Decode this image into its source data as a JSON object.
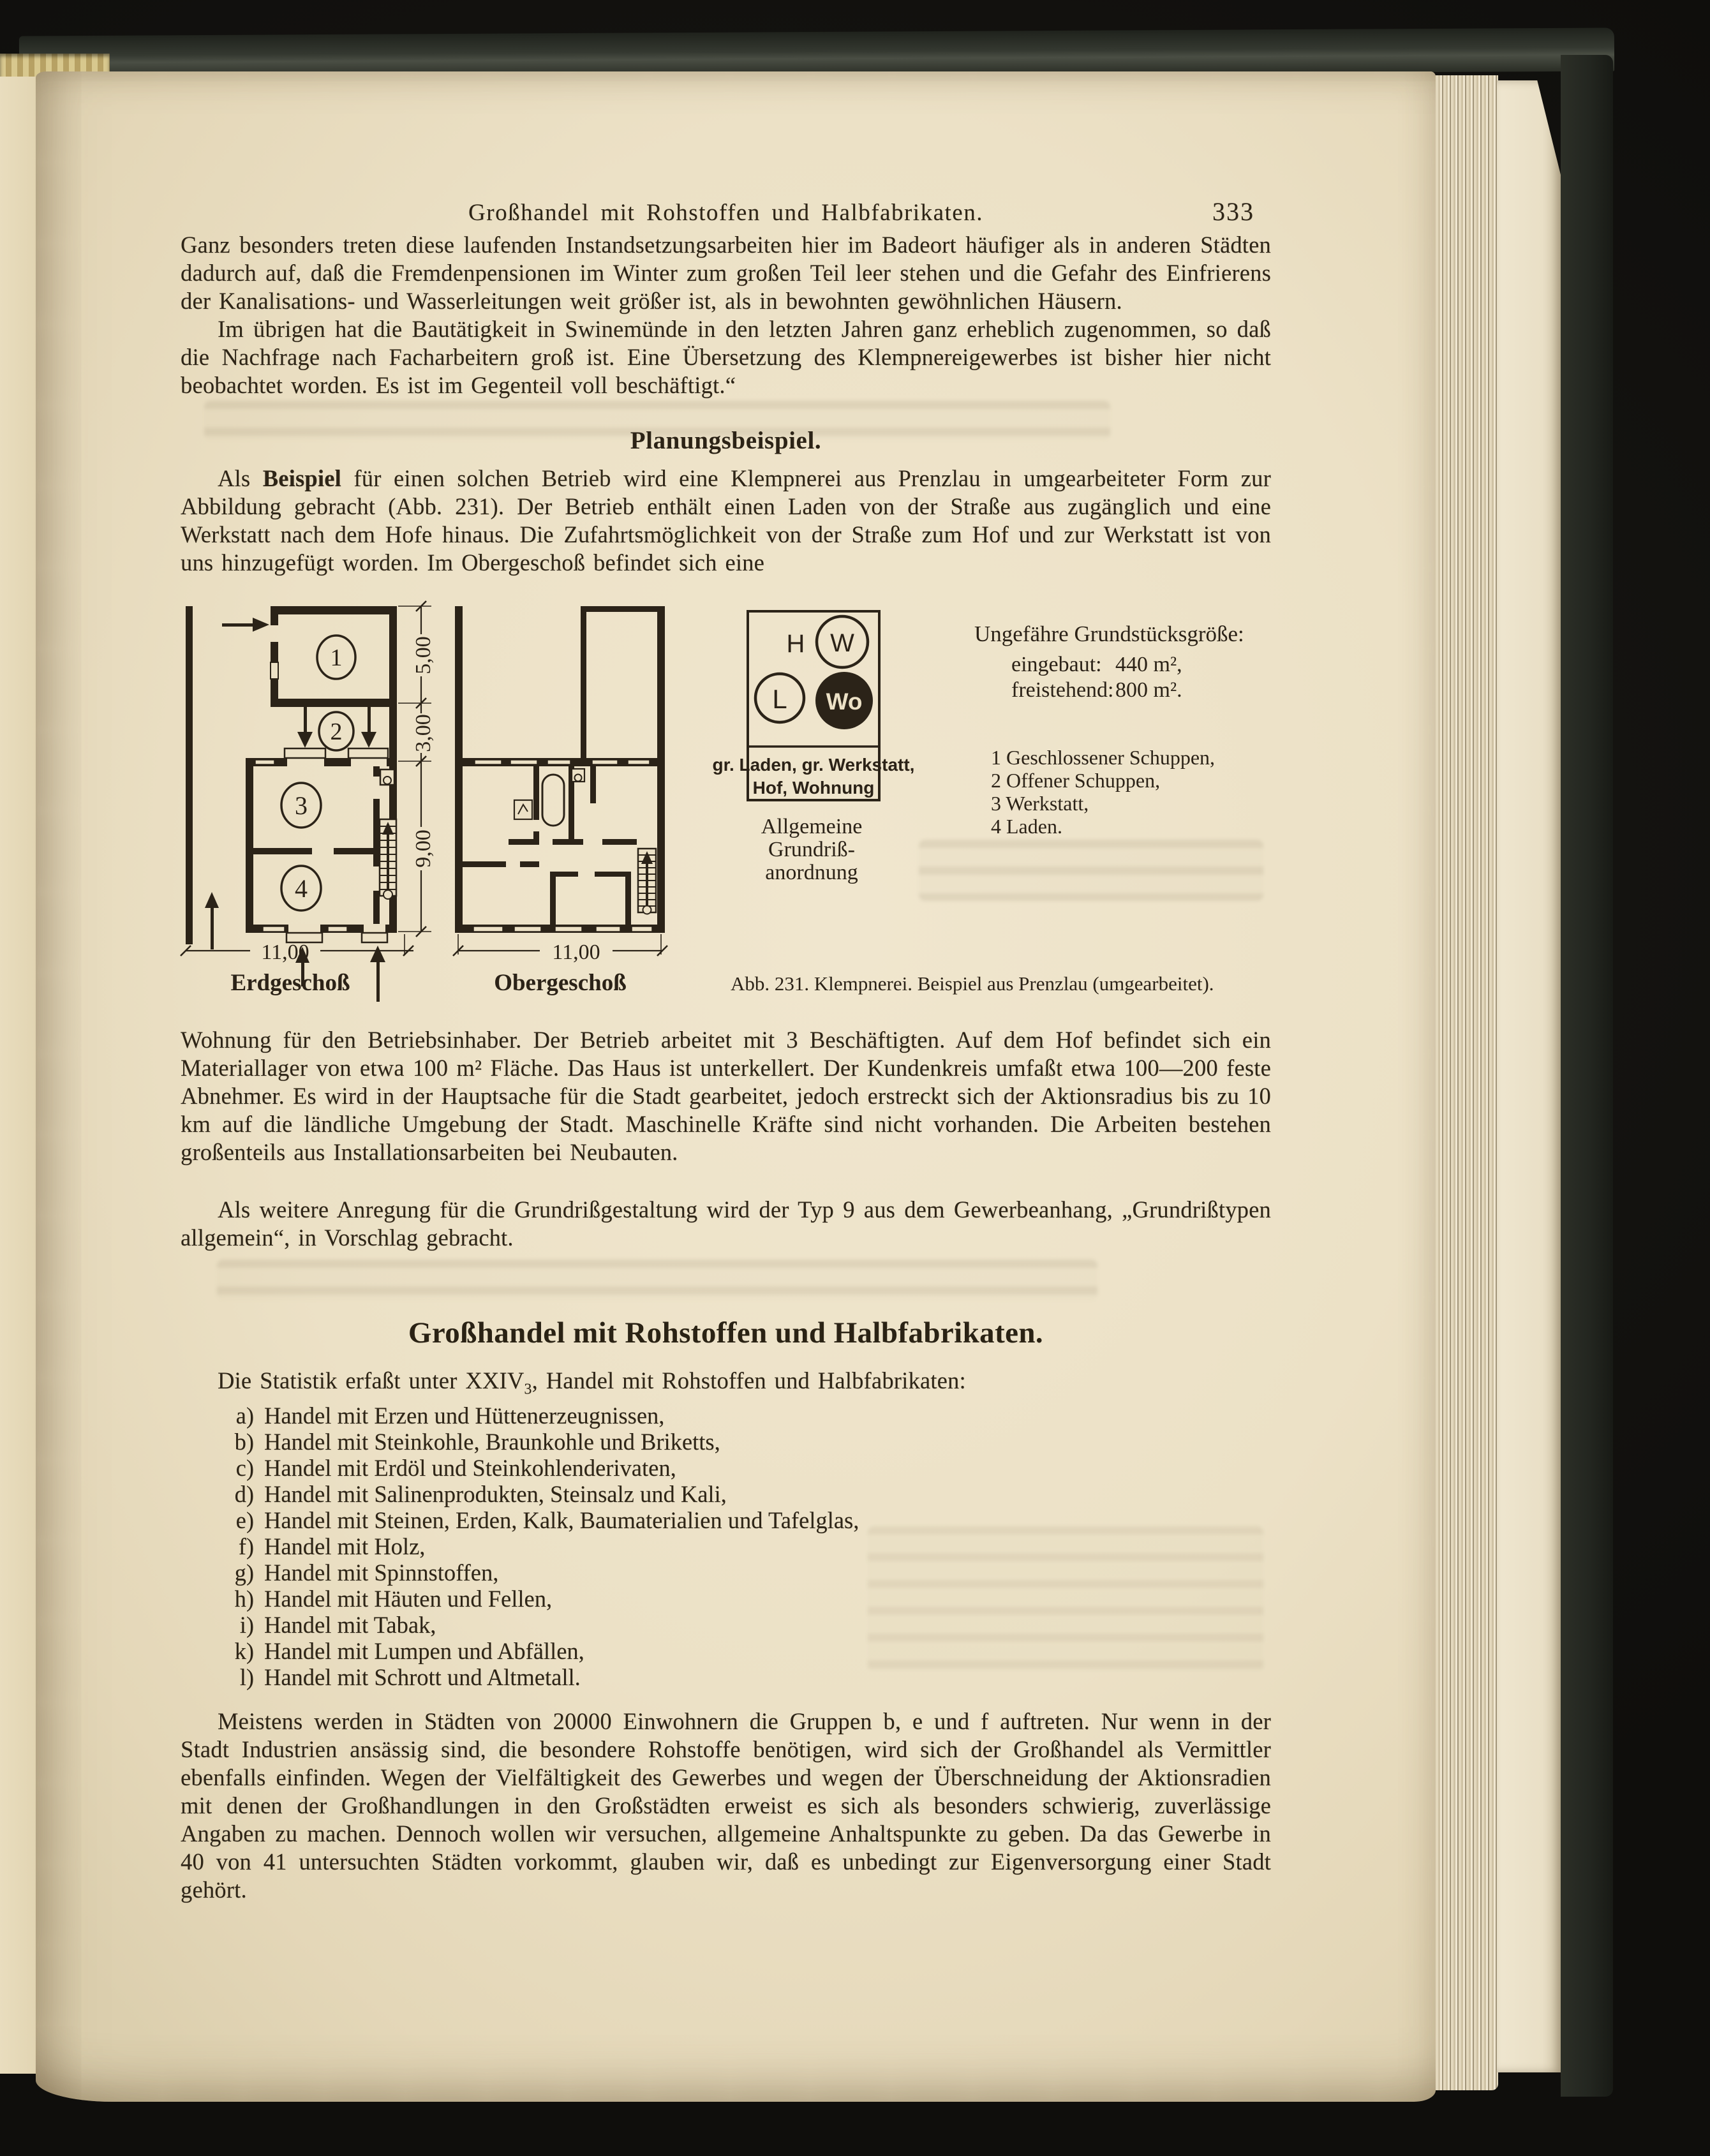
{
  "header": {
    "running_head": "Großhandel mit Rohstoffen und Halbfabrikaten.",
    "page_number": "333"
  },
  "body": {
    "p1": "Ganz besonders treten diese laufenden Instandsetzungsarbeiten hier im Badeort häufiger als in anderen Städten dadurch auf, daß die Fremdenpensionen im Winter zum großen Teil leer stehen und die Gefahr des Einfrierens der Kanalisations- und Wasserleitungen weit größer ist, als in bewohnten gewöhnlichen Häusern.",
    "p2": "Im übrigen hat die Bautätigkeit in Swinemünde in den letzten Jahren ganz erheblich zugenommen, so daß die Nachfrage nach Facharbeitern groß ist. Eine Übersetzung des Klempnereigewerbes ist bisher hier nicht beobachtet worden. Es ist im Gegenteil voll beschäftigt.“",
    "planung_heading": "Planungsbeispiel.",
    "p3_pre": "Als ",
    "p3_bold": "Beispiel",
    "p3_post": " für einen solchen Betrieb wird eine Klempnerei aus Prenzlau in umgearbeiteter Form zur Abbildung gebracht (Abb. 231). Der Betrieb enthält einen Laden von der Straße aus zugänglich und eine Werkstatt nach dem Hofe hinaus. Die Zufahrtsmöglichkeit von der Straße zum Hof und zur Werkstatt ist von uns hinzugefügt worden. Im Obergeschoß befindet sich eine",
    "p4": "Wohnung für den Betriebsinhaber. Der Betrieb arbeitet mit 3 Beschäftigten. Auf dem Hof befindet sich ein Materiallager von etwa 100 m² Fläche. Das Haus ist unterkellert. Der Kundenkreis umfaßt etwa 100—200 feste Abnehmer. Es wird in der Hauptsache für die Stadt gearbeitet, jedoch erstreckt sich der Aktionsradius bis zu 10 km auf die ländliche Umgebung der Stadt. Maschinelle Kräfte sind nicht vorhanden. Die Arbeiten bestehen großenteils aus Installationsarbeiten bei Neubauten.",
    "p5": "Als weitere Anregung für die Grundrißgestaltung wird der Typ 9 aus dem Gewerbeanhang, „Grundrißtypen allgemein“, in Vorschlag gebracht."
  },
  "figure": {
    "caption": "Abb. 231. Klempnerei. Beispiel aus Prenzlau (umgearbeitet).",
    "plans": {
      "erdgeschoss_label": "Erdgeschoß",
      "obergeschoss_label": "Obergeschoß",
      "room_numbers": [
        "1",
        "2",
        "3",
        "4"
      ],
      "dim_5": "5,00",
      "dim_3": "3,00",
      "dim_9": "9,00",
      "dim_11_left": "11,00",
      "dim_11_right": "11,00"
    },
    "schematic": {
      "h_label": "H",
      "w_label": "W",
      "l_label": "L",
      "wo_label": "Wo",
      "box_line1": "gr. Laden, gr. Werkstatt,",
      "box_line2": "Hof, Wohnung",
      "caption_line1": "Allgemeine",
      "caption_line2": "Grundriß-",
      "caption_line3": "anordnung"
    },
    "site_size": {
      "title": "Ungefähre Grundstücksgröße:",
      "built_label": "eingebaut:",
      "built_value": "440 m²,",
      "free_label": "freistehend:",
      "free_value": "800 m²."
    },
    "legend": [
      "1 Geschlossener Schuppen,",
      "2 Offener Schuppen,",
      "3 Werkstatt,",
      "4 Laden."
    ]
  },
  "section": {
    "heading": "Großhandel mit Rohstoffen und Halbfabrikaten.",
    "intro_pre": "Die Statistik erfaßt unter XXIV",
    "intro_sub": "3",
    "intro_post": ", Handel mit Rohstoffen und Halbfabrikaten:",
    "items": [
      {
        "label": "a)",
        "text": "Handel mit Erzen und Hüttenerzeugnissen,"
      },
      {
        "label": "b)",
        "text": "Handel mit Steinkohle, Braunkohle und Briketts,"
      },
      {
        "label": "c)",
        "text": "Handel mit Erdöl und Steinkohlenderivaten,"
      },
      {
        "label": "d)",
        "text": "Handel mit Salinenprodukten, Steinsalz und Kali,"
      },
      {
        "label": "e)",
        "text": "Handel mit Steinen, Erden, Kalk, Baumaterialien und Tafelglas,"
      },
      {
        "label": "f)",
        "text": "Handel mit Holz,"
      },
      {
        "label": "g)",
        "text": "Handel mit Spinnstoffen,"
      },
      {
        "label": "h)",
        "text": "Handel mit Häuten und Fellen,"
      },
      {
        "label": "i)",
        "text": "Handel mit Tabak,"
      },
      {
        "label": "k)",
        "text": "Handel mit Lumpen und Abfällen,"
      },
      {
        "label": "l)",
        "text": "Handel mit Schrott und Altmetall."
      }
    ],
    "closing": "Meistens werden in Städten von 20000 Einwohnern die Gruppen b, e und f auftreten. Nur wenn in der Stadt Industrien ansässig sind, die besondere Rohstoffe benötigen, wird sich der Großhandel als Vermittler ebenfalls einfinden. Wegen der Vielfältigkeit des Gewerbes und wegen der Überschneidung der Aktionsradien mit denen der Großhandlungen in den Großstädten erweist es sich als besonders schwierig, zuverlässige Angaben zu machen. Dennoch wollen wir versuchen, allgemeine Anhaltspunkte zu geben. Da das Gewerbe in 40 von 41 untersuchten Städten vorkommt, glauben wir, daß es unbedingt zur Eigenversorgung einer Stadt gehört."
  },
  "colors": {
    "paper": "#ece1c6",
    "ink": "#2e2517",
    "cover": "#2a2d25",
    "background": "#141310"
  }
}
